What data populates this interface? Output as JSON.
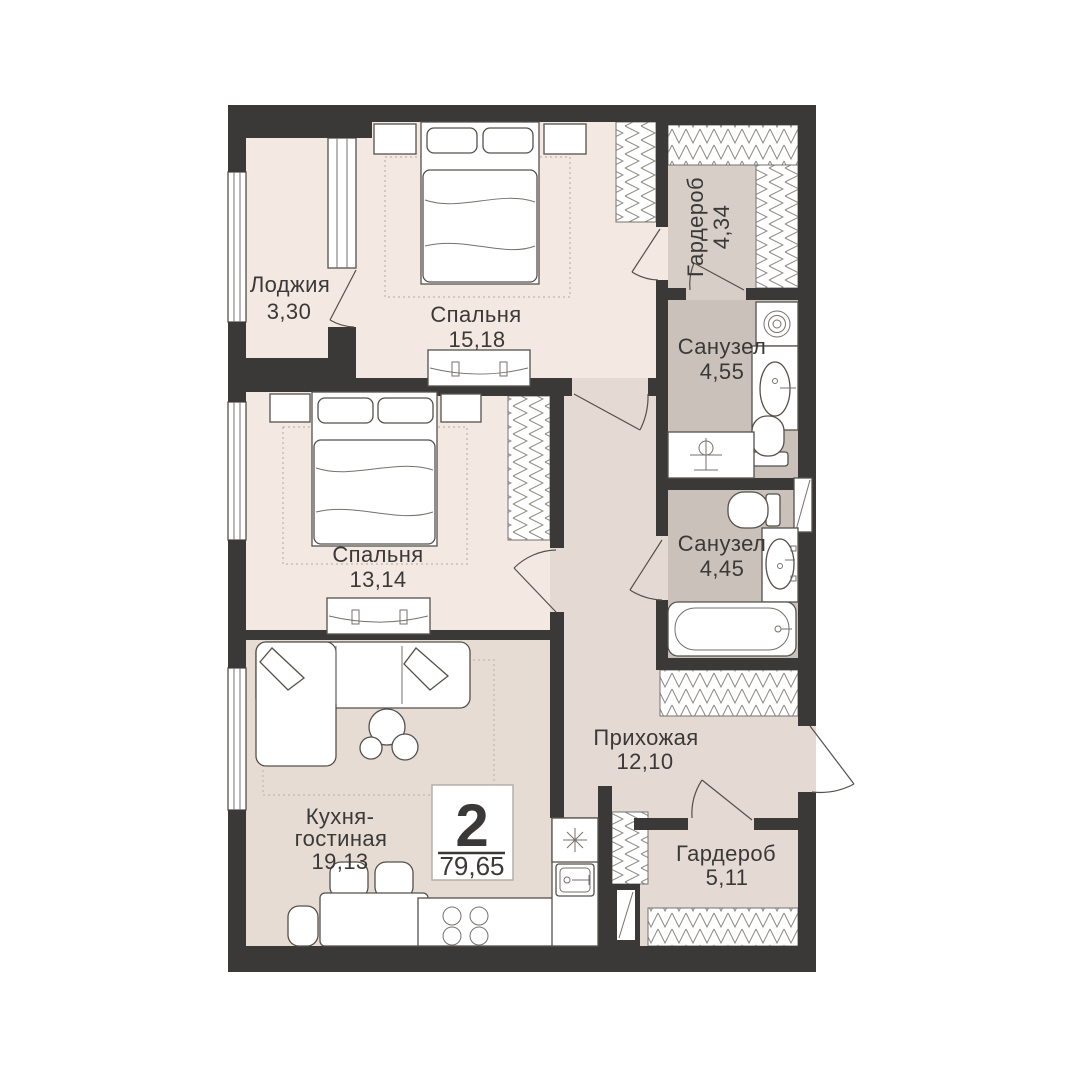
{
  "badge": {
    "rooms_count": "2",
    "total_area": "79,65"
  },
  "rooms": {
    "loggia": {
      "name": "Лоджия",
      "area": "3,30"
    },
    "bedroom1": {
      "name": "Спальня",
      "area": "15,18"
    },
    "wardrobe1": {
      "name": "Гардероб",
      "area": "4,34"
    },
    "bathroom1": {
      "name": "Санузел",
      "area": "4,55"
    },
    "bedroom2": {
      "name": "Спальня",
      "area": "13,14"
    },
    "bathroom2": {
      "name": "Санузел",
      "area": "4,45"
    },
    "hallway": {
      "name": "Прихожая",
      "area": "12,10"
    },
    "kitchen": {
      "name_line1": "Кухня-",
      "name_line2": "гостиная",
      "area": "19,13"
    },
    "wardrobe2": {
      "name": "Гардероб",
      "area": "5,11"
    }
  },
  "colors": {
    "wall": "#3b3937",
    "room_floor": "#f3e8e2",
    "wet_floor": "#cac1ba",
    "hall_floor": "#e5dad3",
    "kitchen_floor": "#e7dcd4",
    "wardrobe_floor": "#d7cec7",
    "text": "#3b3937",
    "carpet_dash": "#cdbdb2",
    "badge_border": "#b3afab"
  }
}
